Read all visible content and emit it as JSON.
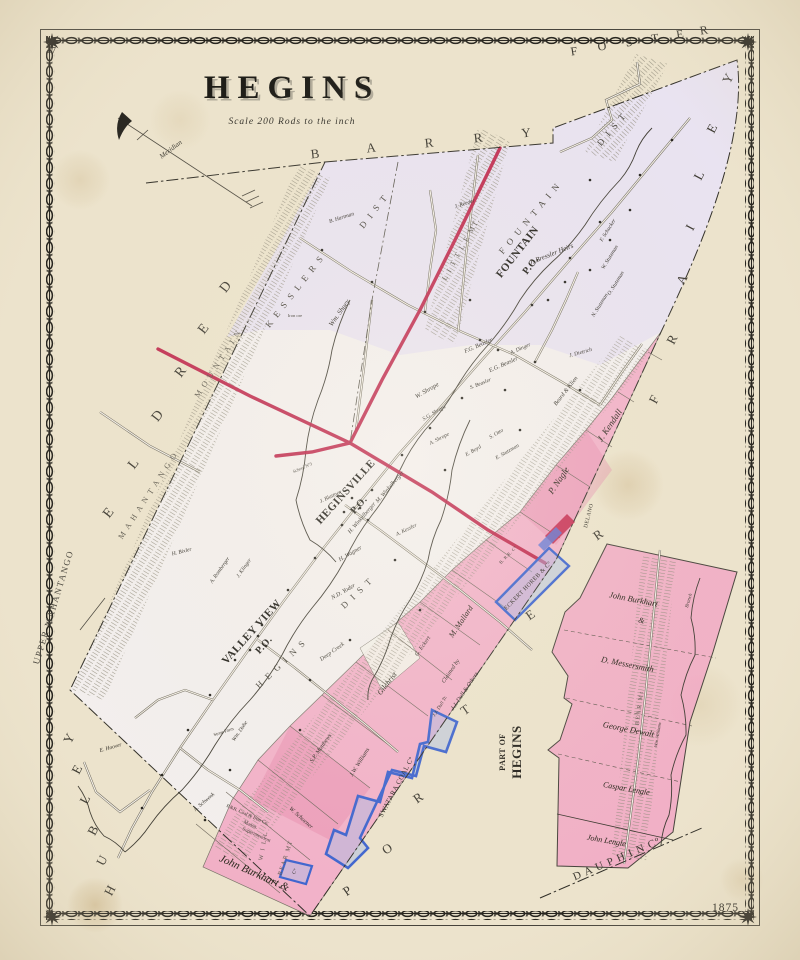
{
  "page": {
    "number": "47",
    "year": "1875"
  },
  "title": {
    "main": "HEGINS",
    "scale": "Scale 200 Rods to the inch"
  },
  "colors": {
    "paper": "#ece3cc",
    "township_base": "#f3efee",
    "lavender_wash": "#e6dff2",
    "pink_wash": "#f2abc6",
    "turnpike_red": "#bd2047",
    "coal_parcel_blue": "#3c63cf",
    "ink": "#23211c"
  },
  "map": {
    "texts": [
      {
        "t": "B",
        "x": 316,
        "y": 158,
        "r": -6,
        "s": 13,
        "c": "nbr"
      },
      {
        "t": "A",
        "x": 372,
        "y": 152,
        "r": -6,
        "s": 13,
        "c": "nbr"
      },
      {
        "t": "R",
        "x": 430,
        "y": 147,
        "r": -6,
        "s": 13,
        "c": "nbr"
      },
      {
        "t": "R",
        "x": 479,
        "y": 142,
        "r": -6,
        "s": 13,
        "c": "nbr"
      },
      {
        "t": "Y",
        "x": 527,
        "y": 137,
        "r": -6,
        "s": 13,
        "c": "nbr"
      },
      {
        "t": "F",
        "x": 575,
        "y": 55,
        "r": -9,
        "s": 12,
        "c": "nbr"
      },
      {
        "t": "O",
        "x": 603,
        "y": 50,
        "r": -9,
        "s": 12,
        "c": "nbr"
      },
      {
        "t": "S",
        "x": 630,
        "y": 46,
        "r": -9,
        "s": 12,
        "c": "nbr"
      },
      {
        "t": "T",
        "x": 656,
        "y": 42,
        "r": -9,
        "s": 12,
        "c": "nbr"
      },
      {
        "t": "E",
        "x": 681,
        "y": 38,
        "r": -9,
        "s": 12,
        "c": "nbr"
      },
      {
        "t": "R",
        "x": 705,
        "y": 34,
        "r": -9,
        "s": 12,
        "c": "nbr"
      },
      {
        "t": "Y",
        "x": 732,
        "y": 80,
        "r": -62,
        "s": 13,
        "c": "nbr"
      },
      {
        "t": "E",
        "x": 716,
        "y": 130,
        "r": -62,
        "s": 13,
        "c": "nbr"
      },
      {
        "t": "L",
        "x": 703,
        "y": 177,
        "r": -62,
        "s": 13,
        "c": "nbr"
      },
      {
        "t": "I",
        "x": 694,
        "y": 229,
        "r": -62,
        "s": 13,
        "c": "nbr"
      },
      {
        "t": "A",
        "x": 686,
        "y": 281,
        "r": -62,
        "s": 13,
        "c": "nbr"
      },
      {
        "t": "R",
        "x": 676,
        "y": 341,
        "r": -62,
        "s": 13,
        "c": "nbr"
      },
      {
        "t": "F",
        "x": 658,
        "y": 401,
        "r": -62,
        "s": 13,
        "c": "nbr"
      },
      {
        "t": "D",
        "x": 229,
        "y": 289,
        "r": -52,
        "s": 14,
        "c": "nbr"
      },
      {
        "t": "E",
        "x": 207,
        "y": 331,
        "r": -52,
        "s": 14,
        "c": "nbr"
      },
      {
        "t": "R",
        "x": 184,
        "y": 374,
        "r": -52,
        "s": 14,
        "c": "nbr"
      },
      {
        "t": "D",
        "x": 161,
        "y": 418,
        "r": -52,
        "s": 14,
        "c": "nbr"
      },
      {
        "t": "L",
        "x": 137,
        "y": 466,
        "r": -52,
        "s": 14,
        "c": "nbr"
      },
      {
        "t": "E",
        "x": 112,
        "y": 515,
        "r": -52,
        "s": 14,
        "c": "nbr"
      },
      {
        "t": "Y",
        "x": 73,
        "y": 740,
        "r": -62,
        "s": 13,
        "c": "nbr"
      },
      {
        "t": "E",
        "x": 81,
        "y": 771,
        "r": -62,
        "s": 13,
        "c": "nbr"
      },
      {
        "t": "L",
        "x": 89,
        "y": 801,
        "r": -62,
        "s": 13,
        "c": "nbr"
      },
      {
        "t": "B",
        "x": 97,
        "y": 832,
        "r": -62,
        "s": 13,
        "c": "nbr"
      },
      {
        "t": "U",
        "x": 106,
        "y": 862,
        "r": -62,
        "s": 13,
        "c": "nbr"
      },
      {
        "t": "H",
        "x": 114,
        "y": 892,
        "r": -62,
        "s": 13,
        "c": "nbr"
      },
      {
        "t": "P",
        "x": 350,
        "y": 894,
        "r": -35,
        "s": 13,
        "c": "nbr"
      },
      {
        "t": "O",
        "x": 390,
        "y": 852,
        "r": -35,
        "s": 13,
        "c": "nbr"
      },
      {
        "t": "R",
        "x": 421,
        "y": 801,
        "r": -35,
        "s": 13,
        "c": "nbr"
      },
      {
        "t": "T",
        "x": 468,
        "y": 713,
        "r": -35,
        "s": 13,
        "c": "nbr"
      },
      {
        "t": "E",
        "x": 533,
        "y": 618,
        "r": -35,
        "s": 13,
        "c": "nbr"
      },
      {
        "t": "R",
        "x": 601,
        "y": 538,
        "r": -35,
        "s": 13,
        "c": "nbr"
      },
      {
        "t": "D A U P H I N   Cº",
        "x": 618,
        "y": 862,
        "r": -23,
        "s": 11,
        "c": "nbr"
      },
      {
        "t": "UPPER MAHANTANGO",
        "x": 56,
        "y": 608,
        "r": -73,
        "s": 9,
        "c": "nbr2"
      },
      {
        "t": "M A H A N T A N G O",
        "x": 150,
        "y": 497,
        "r": -57,
        "s": 8,
        "c": "mt"
      },
      {
        "t": "M O U N T A I N",
        "x": 220,
        "y": 365,
        "r": -57,
        "s": 8,
        "c": "mt"
      },
      {
        "t": "L I T T L E   MT.",
        "x": 463,
        "y": 250,
        "r": -61,
        "s": 7.5,
        "c": "mt"
      },
      {
        "t": "BEAR MT",
        "x": 287,
        "y": 858,
        "r": -72,
        "s": 6,
        "c": "mt"
      },
      {
        "t": "BEAR Mt",
        "x": 641,
        "y": 708,
        "r": -83,
        "s": 6,
        "c": "mt"
      },
      {
        "t": "W I L L",
        "x": 265,
        "y": 846,
        "r": -80,
        "s": 6,
        "c": "mt"
      },
      {
        "t": "K E S S L E R S",
        "x": 297,
        "y": 293,
        "r": -52,
        "s": 9,
        "c": "dist"
      },
      {
        "t": "D I S T",
        "x": 376,
        "y": 213,
        "r": -52,
        "s": 9,
        "c": "dist"
      },
      {
        "t": "F O U N T A I N",
        "x": 532,
        "y": 220,
        "r": -50,
        "s": 9,
        "c": "dist"
      },
      {
        "t": "D I S T",
        "x": 614,
        "y": 131,
        "r": -50,
        "s": 9,
        "c": "dist"
      },
      {
        "t": "H E G I N S",
        "x": 283,
        "y": 666,
        "r": -44,
        "s": 9,
        "c": "dist"
      },
      {
        "t": "D I S T",
        "x": 359,
        "y": 595,
        "r": -44,
        "s": 9,
        "c": "dist"
      },
      {
        "t": "FOUNTAIN",
        "x": 520,
        "y": 254,
        "r": -52,
        "s": 11,
        "c": "po"
      },
      {
        "t": "P.O.",
        "x": 533,
        "y": 267,
        "r": -52,
        "s": 10,
        "c": "po"
      },
      {
        "t": "HEGINSVILLE",
        "x": 348,
        "y": 494,
        "r": -48,
        "s": 11,
        "c": "po"
      },
      {
        "t": "P.O.",
        "x": 361,
        "y": 507,
        "r": -48,
        "s": 10,
        "c": "po"
      },
      {
        "t": "VALLEY VIEW",
        "x": 254,
        "y": 634,
        "r": -48,
        "s": 11,
        "c": "po"
      },
      {
        "t": "P.O.",
        "x": 266,
        "y": 647,
        "r": -48,
        "s": 10,
        "c": "po"
      },
      {
        "t": "PART OF",
        "x": 505,
        "y": 752,
        "r": -90,
        "s": 8,
        "c": "po"
      },
      {
        "t": "HEGINS",
        "x": 521,
        "y": 752,
        "r": -90,
        "s": 13,
        "c": "po"
      },
      {
        "t": "SWATARA COAL Cº",
        "x": 398,
        "y": 788,
        "r": -62,
        "s": 7,
        "c": "co"
      },
      {
        "t": "ECKERT HOREB & Cº",
        "x": 529,
        "y": 587,
        "r": -46,
        "s": 6,
        "c": "co"
      },
      {
        "t": "DELANO",
        "x": 590,
        "y": 516,
        "r": -76,
        "s": 5.5,
        "c": "co"
      },
      {
        "t": "B. R.R. Cº",
        "x": 509,
        "y": 556,
        "r": -46,
        "s": 4.5,
        "c": "co"
      },
      {
        "t": "P.&R. Coal & Iron Co.",
        "x": 247,
        "y": 816,
        "r": 24,
        "s": 5,
        "c": "note"
      },
      {
        "t": "Mansn.",
        "x": 250,
        "y": 826,
        "r": 24,
        "s": 5,
        "c": "note"
      },
      {
        "t": "Superintendent",
        "x": 256,
        "y": 836,
        "r": 24,
        "s": 5,
        "c": "note"
      },
      {
        "t": "Cº",
        "x": 296,
        "y": 872,
        "r": -62,
        "s": 5,
        "c": "co"
      },
      {
        "t": "J. Bressler Heirs",
        "x": 552,
        "y": 256,
        "r": -22,
        "s": 7,
        "c": "own"
      },
      {
        "t": "F. Schucker",
        "x": 609,
        "y": 231,
        "r": -58,
        "s": 5.5,
        "c": "own"
      },
      {
        "t": "W. Stutzman",
        "x": 611,
        "y": 258,
        "r": -58,
        "s": 5.5,
        "c": "own"
      },
      {
        "t": "O. Stutzman",
        "x": 617,
        "y": 284,
        "r": -58,
        "s": 5.5,
        "c": "own"
      },
      {
        "t": "N. Stutzman",
        "x": 601,
        "y": 306,
        "r": -58,
        "s": 5.5,
        "c": "own"
      },
      {
        "t": "F.G. Beasler",
        "x": 479,
        "y": 347,
        "r": -24,
        "s": 6,
        "c": "own"
      },
      {
        "t": "E.G. Beasler",
        "x": 504,
        "y": 366,
        "r": -24,
        "s": 6,
        "c": "own"
      },
      {
        "t": "S. Beasler",
        "x": 481,
        "y": 385,
        "r": -22,
        "s": 5.5,
        "c": "own"
      },
      {
        "t": "A. Dinger",
        "x": 521,
        "y": 350,
        "r": -24,
        "s": 5.5,
        "c": "own"
      },
      {
        "t": "W. Shrope",
        "x": 428,
        "y": 392,
        "r": -30,
        "s": 6.5,
        "c": "own"
      },
      {
        "t": "S.G. Shrope",
        "x": 435,
        "y": 414,
        "r": -30,
        "s": 5.5,
        "c": "own"
      },
      {
        "t": "A. Shrope",
        "x": 440,
        "y": 440,
        "r": -28,
        "s": 5.5,
        "c": "own"
      },
      {
        "t": "S. Otto",
        "x": 497,
        "y": 435,
        "r": -30,
        "s": 5.5,
        "c": "own"
      },
      {
        "t": "E. Boyd",
        "x": 474,
        "y": 452,
        "r": -30,
        "s": 5.5,
        "c": "own"
      },
      {
        "t": "E. Stutzman",
        "x": 508,
        "y": 453,
        "r": -30,
        "s": 5.5,
        "c": "own"
      },
      {
        "t": "Beard & Klien",
        "x": 567,
        "y": 392,
        "r": -52,
        "s": 6,
        "c": "own"
      },
      {
        "t": "J. Dietrich",
        "x": 581,
        "y": 354,
        "r": -16,
        "s": 5.5,
        "c": "own"
      },
      {
        "t": "J. Kendall",
        "x": 612,
        "y": 427,
        "r": -56,
        "s": 9,
        "c": "ownb"
      },
      {
        "t": "P. Nagle",
        "x": 561,
        "y": 482,
        "r": -56,
        "s": 9,
        "c": "ownb"
      },
      {
        "t": "M. Mallard",
        "x": 463,
        "y": 623,
        "r": -56,
        "s": 8,
        "c": "ownb"
      },
      {
        "t": "Claimed by",
        "x": 452,
        "y": 672,
        "r": -56,
        "s": 6,
        "c": "own"
      },
      {
        "t": "J.J. Dull & Others",
        "x": 466,
        "y": 692,
        "r": -56,
        "s": 6,
        "c": "own"
      },
      {
        "t": "Gilchrist",
        "x": 389,
        "y": 685,
        "r": -52,
        "s": 7.5,
        "c": "ownb"
      },
      {
        "t": "G. Eckert",
        "x": 424,
        "y": 647,
        "r": -55,
        "s": 6,
        "c": "own"
      },
      {
        "t": "S.P. Matthews",
        "x": 322,
        "y": 749,
        "r": -55,
        "s": 6,
        "c": "own"
      },
      {
        "t": "M. Winkelberger",
        "x": 391,
        "y": 488,
        "r": -49,
        "s": 6,
        "c": "own"
      },
      {
        "t": "H. Winkelberger",
        "x": 363,
        "y": 519,
        "r": -49,
        "s": 6,
        "c": "own"
      },
      {
        "t": "H. Wagner",
        "x": 351,
        "y": 555,
        "r": -30,
        "s": 6,
        "c": "own"
      },
      {
        "t": "N.D. Yoder",
        "x": 344,
        "y": 593,
        "r": -30,
        "s": 6,
        "c": "own"
      },
      {
        "t": "A. Kessler",
        "x": 407,
        "y": 531,
        "r": -26,
        "s": 5.5,
        "c": "own"
      },
      {
        "t": "J. Blattner",
        "x": 331,
        "y": 498,
        "r": -26,
        "s": 5.5,
        "c": "own"
      },
      {
        "t": "H. Bixler",
        "x": 182,
        "y": 553,
        "r": -14,
        "s": 5.5,
        "c": "own"
      },
      {
        "t": "A. Romberger",
        "x": 221,
        "y": 571,
        "r": -55,
        "s": 5.5,
        "c": "own"
      },
      {
        "t": "J. Klinger",
        "x": 245,
        "y": 569,
        "r": -55,
        "s": 5.5,
        "c": "own"
      },
      {
        "t": "Wm. Shuey",
        "x": 341,
        "y": 314,
        "r": -55,
        "s": 7,
        "c": "own"
      },
      {
        "t": "B. Hartman",
        "x": 342,
        "y": 219,
        "r": -18,
        "s": 5.5,
        "c": "own"
      },
      {
        "t": "J. Reeder",
        "x": 465,
        "y": 205,
        "r": -18,
        "s": 5.5,
        "c": "own"
      },
      {
        "t": "J.W. Williams",
        "x": 361,
        "y": 763,
        "r": -58,
        "s": 6,
        "c": "own"
      },
      {
        "t": "J.J. Dull Tr.",
        "x": 441,
        "y": 707,
        "r": -58,
        "s": 5,
        "c": "own"
      },
      {
        "t": "Wm. Dohe",
        "x": 241,
        "y": 732,
        "r": -55,
        "s": 5.5,
        "c": "own"
      },
      {
        "t": "A. Schwenk",
        "x": 205,
        "y": 803,
        "r": -40,
        "s": 5.5,
        "c": "own"
      },
      {
        "t": "E. Hoover",
        "x": 111,
        "y": 749,
        "r": -16,
        "s": 5.5,
        "c": "own"
      },
      {
        "t": "John Burkhart &",
        "x": 253,
        "y": 876,
        "r": 24,
        "s": 11,
        "c": "ownb"
      },
      {
        "t": "W. Schoener",
        "x": 300,
        "y": 819,
        "r": 42,
        "s": 6,
        "c": "own"
      },
      {
        "t": "John Burkhart",
        "x": 633,
        "y": 602,
        "r": 11,
        "s": 8.5,
        "c": "ownb"
      },
      {
        "t": "&",
        "x": 641,
        "y": 623,
        "r": 11,
        "s": 8,
        "c": "own"
      },
      {
        "t": "D. Messersmith",
        "x": 627,
        "y": 667,
        "r": 11,
        "s": 8.5,
        "c": "ownb"
      },
      {
        "t": "George Dewalt",
        "x": 628,
        "y": 732,
        "r": 11,
        "s": 8.5,
        "c": "ownb"
      },
      {
        "t": "Caspar Lengle",
        "x": 626,
        "y": 791,
        "r": 10,
        "s": 8,
        "c": "ownb"
      },
      {
        "t": "John Lengle",
        "x": 606,
        "y": 843,
        "r": 10,
        "s": 8,
        "c": "ownb"
      },
      {
        "t": "Wm. Williams",
        "x": 659,
        "y": 735,
        "r": -80,
        "s": 4.5,
        "c": "own"
      },
      {
        "t": "Stone Farm",
        "x": 224,
        "y": 733,
        "r": -18,
        "s": 4.5,
        "c": "note"
      },
      {
        "t": "School Nº3",
        "x": 303,
        "y": 469,
        "r": -24,
        "s": 4.5,
        "c": "note"
      },
      {
        "t": "Iron ore",
        "x": 295,
        "y": 317,
        "r": 0,
        "s": 4.5,
        "c": "note"
      },
      {
        "t": "Deep Creek",
        "x": 333,
        "y": 653,
        "r": -35,
        "s": 6,
        "c": "creek"
      },
      {
        "t": "Branch",
        "x": 690,
        "y": 601,
        "r": -73,
        "s": 5,
        "c": "creek"
      },
      {
        "t": "Meridian",
        "x": 172,
        "y": 151,
        "r": -37,
        "s": 7,
        "c": "creek"
      }
    ]
  }
}
